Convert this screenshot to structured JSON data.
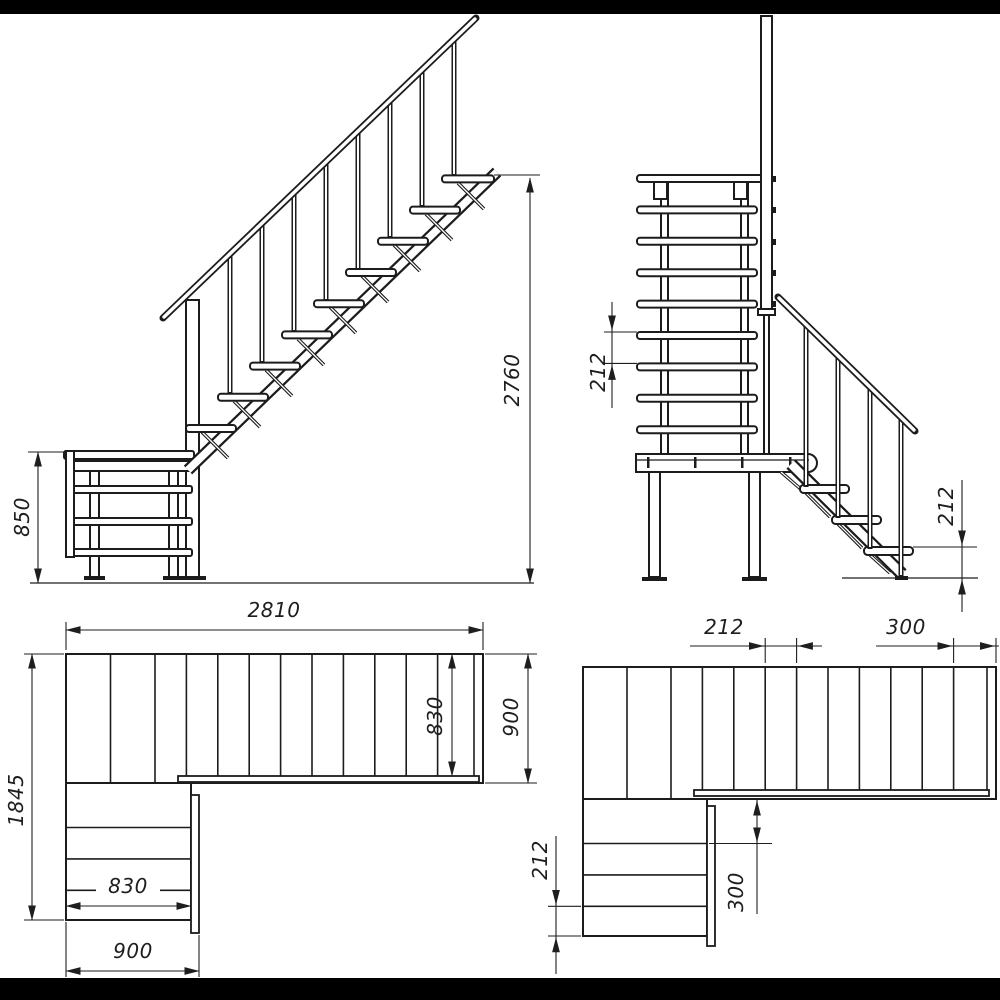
{
  "drawing": {
    "kind": "staircase-technical-drawing",
    "colors": {
      "paper": "#ffffff",
      "line": "#1c1c1c",
      "letterbox": "#000000"
    },
    "views": {
      "side_elevation": {
        "label": "side-elevation-upper-flight",
        "dims": {
          "platform_height": "850",
          "total_height": "2760"
        }
      },
      "front_elevation": {
        "label": "front-elevation-with-lower-flight",
        "dims": {
          "upper_riser": "212",
          "lower_riser": "212"
        }
      },
      "plan_left": {
        "label": "plan-view-overall",
        "dims": {
          "total_length": "2810",
          "total_depth": "1845",
          "upper_tread_length": "830",
          "upper_flight_width": "900",
          "lower_tread_length": "830",
          "lower_flight_width": "900"
        }
      },
      "plan_right": {
        "label": "plan-view-tread-spacing",
        "dims": {
          "upper_tread_spacing": "212",
          "upper_top_tread_depth": "300",
          "lower_tread_spacing": "212",
          "lower_first_tread_depth": "300"
        }
      }
    }
  }
}
